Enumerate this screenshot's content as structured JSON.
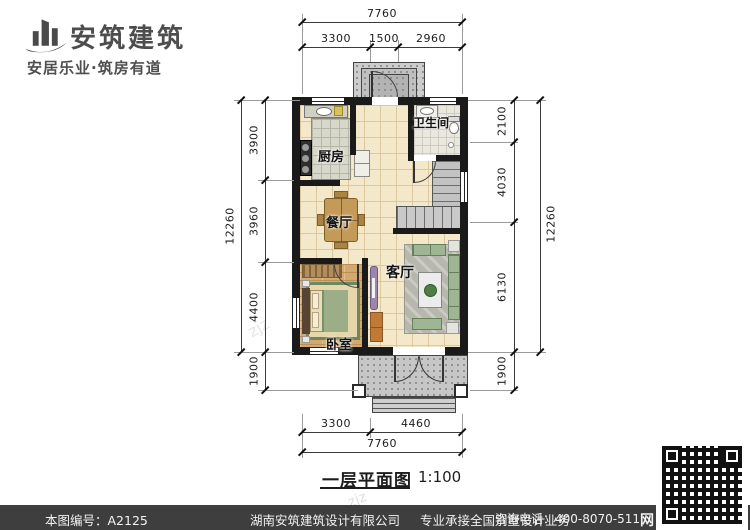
{
  "logo": {
    "name": "安筑建筑",
    "tagline": "安居乐业·筑房有道"
  },
  "plan": {
    "rooms": {
      "kitchen": "厨房",
      "bath": "卫生间",
      "dining": "餐厅",
      "living": "客厅",
      "bedroom": "卧室"
    },
    "dims": {
      "top": {
        "overall": "7760",
        "seg": [
          "3300",
          "1500",
          "2960"
        ]
      },
      "bottom": {
        "overall": "7760",
        "seg": [
          "3300",
          "4460"
        ]
      },
      "left": {
        "overall": "12260",
        "seg": [
          "3900",
          "3960",
          "4400"
        ],
        "porch": "1900"
      },
      "right": {
        "overall": "12260",
        "seg": [
          "2100",
          "4030",
          "6130"
        ],
        "porch": "1900"
      }
    },
    "caption": {
      "title": "一层平面图",
      "scale": "1:100"
    }
  },
  "watermarks": {
    "wm1": "安筑建筑",
    "wm2": "zjz",
    "wm3": "zjz"
  },
  "footer": {
    "plan_no": "本图编号：A2125",
    "company": "湖南安筑建筑设计有限公司",
    "slogan": "专业承接全国别墅设计业务",
    "phone": "咨询电话：400-8070-511",
    "site_mark": "网"
  },
  "colors": {
    "wall": "#1a1a1a",
    "floor": "#f3e8ca",
    "wood": "#d2a96f",
    "porch_gray": "#c6c6c6",
    "footer_bar": "#3e3e3e"
  }
}
